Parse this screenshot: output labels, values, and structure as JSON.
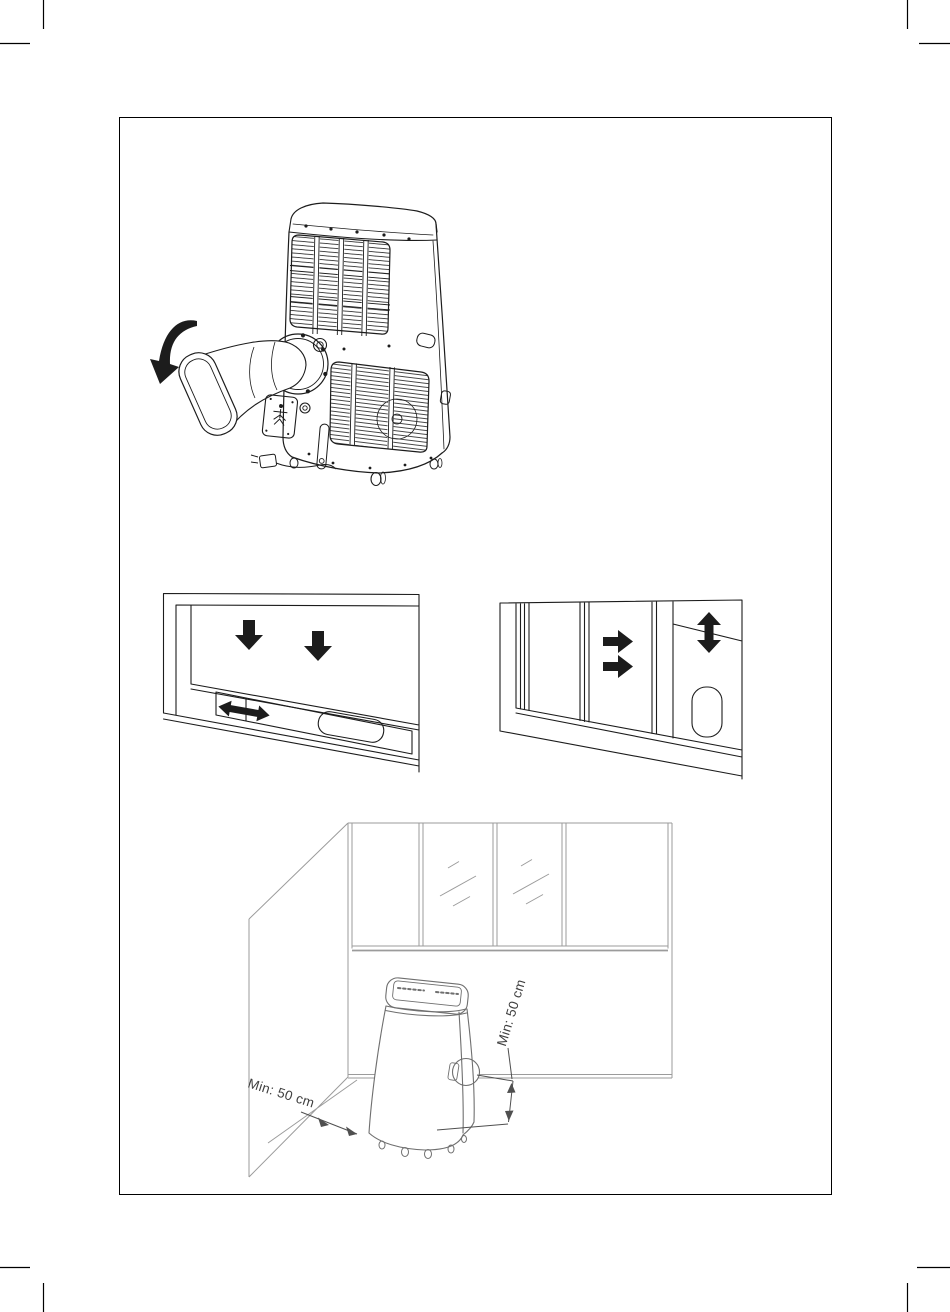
{
  "page": {
    "background": "#ffffff"
  },
  "colors": {
    "paper": "#ffffff",
    "frame": "#000000",
    "ink": "#1c1c1c",
    "room_line": "#9b9b9b",
    "unit_line": "#6f6f6f",
    "dim_line": "#4f4f4f",
    "dim_text": "#3f3f3f"
  },
  "figures": {
    "hose_rotation": {
      "name": "exhaust-hose-attachment-figure"
    },
    "window_horizontal": {
      "name": "slider-kit-horizontal-window-figure"
    },
    "window_vertical": {
      "name": "slider-kit-vertical-window-figure"
    },
    "room_clearance": {
      "name": "room-placement-clearance-figure",
      "label_left": "Min: 50 cm",
      "label_right": "Min: 50 cm"
    }
  }
}
